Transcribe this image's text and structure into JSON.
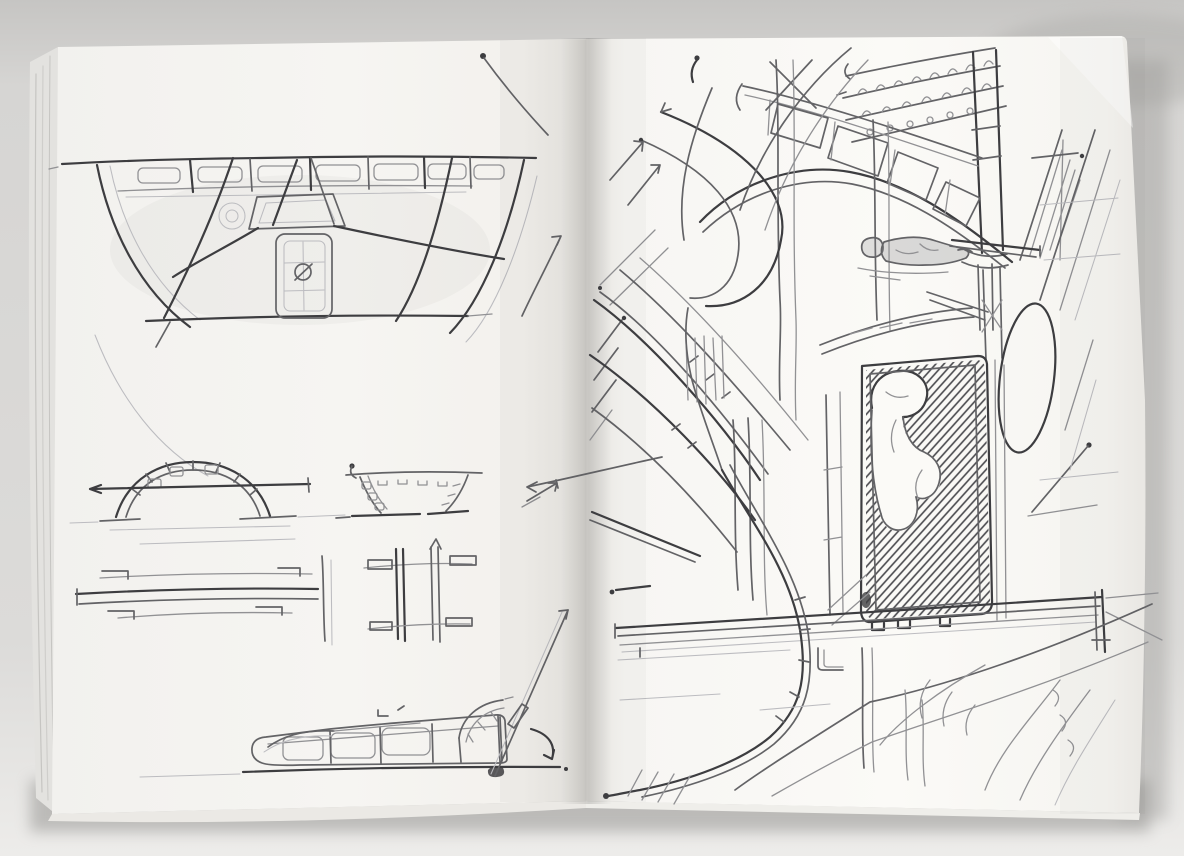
{
  "scene": {
    "type": "photograph",
    "subject": "Open sketchbook spread with architectural pencil sketches on both pages",
    "colors": {
      "backdrop-top": "#c6c5c3",
      "backdrop": "#d9d8d6",
      "backdrop-bottom": "#edecea",
      "paper-left": "#f6f5f2",
      "paper-left-deep": "#eae8e3",
      "paper-right": "#fbfaf7",
      "paper-right-deep": "#edebe6",
      "page-edge": "#e3e2df",
      "edge-line": "#c6c5c2",
      "pencil-dark": "#3d3d40",
      "pencil-mid": "#636366",
      "pencil-light": "#919194",
      "pencil-faint": "#bcbcc0",
      "hatch": "#48484c",
      "cast-shadow": "#8f8e8b"
    },
    "book": {
      "left_page": {
        "description": "Left page: study sheet with a wide fan-shaped window elevation, an arched bridge with voussoir blocks, a small splayed balcony front, layered plan lines with bracket ends, and a low building profile with quarter-fan, leader line and curved arrow",
        "sketches": [
          {
            "name": "fan-window-elevation",
            "description": "Wide curved window elevation with clerestory band of panels, radiating mullions and a central door panel marked with a slashed circle"
          },
          {
            "name": "arch-bridge-study",
            "description": "Semicircular arch with voussoir blocks crossed by a horizontal datum line with arrowhead"
          },
          {
            "name": "curved-balcony-study",
            "description": "Small splayed balcony front with panel tick marks and leader arrow"
          },
          {
            "name": "plan-lines-left",
            "description": "Layered horizontal plan lines with bracket ends and crossing vertical"
          },
          {
            "name": "plan-lines-right",
            "description": "Plan fragment with paired vertical rails and bracketed ends"
          },
          {
            "name": "building-profile-study",
            "description": "Low rounded building profile with three panels, thin canopy curve, quarter fan, rising leader line and curved arrow"
          }
        ]
      },
      "right_page": {
        "description": "Right page: sideways perspective sketch of a grand station interior with corbelled brick cornice, curved panelled gallery, small standing figure, cross-hatched niche holding a sculptural figure, tall oval opening, diagonal roof ribs, whiplash construction curves, long beam and sweeping platform edges",
        "sketches": [
          {
            "name": "corbel-brick-band",
            "description": "Corbelled brick cornice band with rows of arched bricks and circles"
          },
          {
            "name": "corner-column",
            "description": "Dark twin-line column with banding and capital"
          },
          {
            "name": "curved-gallery",
            "description": "Curved gallery band with trapezoidal panels between two rails"
          },
          {
            "name": "standing-figure",
            "description": "Small shaded standing figure drawn sideways beside a long pole"
          },
          {
            "name": "hatched-niche",
            "description": "Tall framed niche filled with diagonal hatching around a pale sculptural figure, castellated sill"
          },
          {
            "name": "oval-window",
            "description": "Tall oval opening beside the niche"
          },
          {
            "name": "roof-ribs",
            "description": "Parallel diagonal roof ribs with stitch ticks and arrowed rays"
          },
          {
            "name": "whiplash-curves",
            "description": "Sweeping construction curves with dotted and hooked ends"
          },
          {
            "name": "hairpin-curve",
            "description": "Large hairpin curve with perpendicular tick marks and dotted end"
          },
          {
            "name": "gallery-beam",
            "description": "Long converging beam lines with vertical end cap"
          },
          {
            "name": "platform-curves",
            "description": "Two long sweeping platform edge curves with seat hooks and hatch strokes"
          }
        ]
      }
    }
  }
}
